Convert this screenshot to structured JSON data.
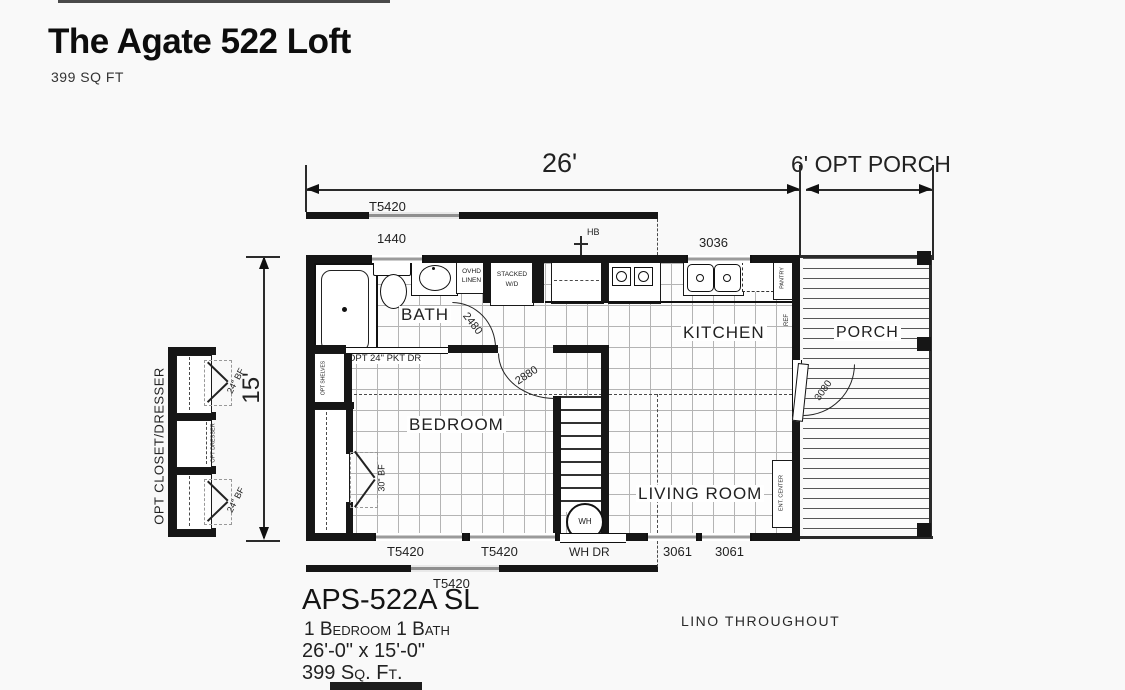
{
  "header": {
    "title": "The Agate 522 Loft",
    "subtitle": "399 SQ FT"
  },
  "dimensions": {
    "width": "26'",
    "porch": "6' OPT PORCH",
    "height": "15'"
  },
  "loft": {
    "top_label": "T5420",
    "bottom_label": "T5420"
  },
  "rooms": {
    "bath": "BATH",
    "kitchen": "KITCHEN",
    "bedroom": "BEDROOM",
    "living_room": "LIVING ROOM",
    "porch": "PORCH"
  },
  "windows": {
    "w1440": "1440",
    "w3036": "3036",
    "bottom_t5420_a": "T5420",
    "bottom_t5420_b": "T5420",
    "w3061_a": "3061",
    "w3061_b": "3061"
  },
  "doors": {
    "pocket": "OPT 24\" PKT DR",
    "bath": "2480",
    "bedroom": "2880",
    "porch": "3080",
    "water_heater": "WH DR",
    "bifold_30": "30\" BF",
    "bifold_24_a": "24\" BF",
    "bifold_24_b": "24\" BF"
  },
  "fixtures": {
    "overhead_linen_1": "OVHD",
    "overhead_linen_2": "LINEN",
    "stacked_wd_1": "STACKED",
    "stacked_wd_2": "W/D",
    "water_heater": "WH",
    "hose_bib": "HB",
    "pantry": "PANTRY",
    "ref": "REF",
    "ent_center": "ENT. CENTER",
    "opt_shelves": "OPT SHELVES"
  },
  "options": {
    "closet_dresser": "OPT CLOSET/DRESSER",
    "dresser": "OPT DRESSER"
  },
  "footer": {
    "model": "APS-522A SL",
    "beds_baths": "1 Bedroom 1 Bath",
    "size": "26'-0\" x 15'-0\"",
    "area": "399  Sq. Ft.",
    "flooring": "LINO THROUGHOUT"
  }
}
